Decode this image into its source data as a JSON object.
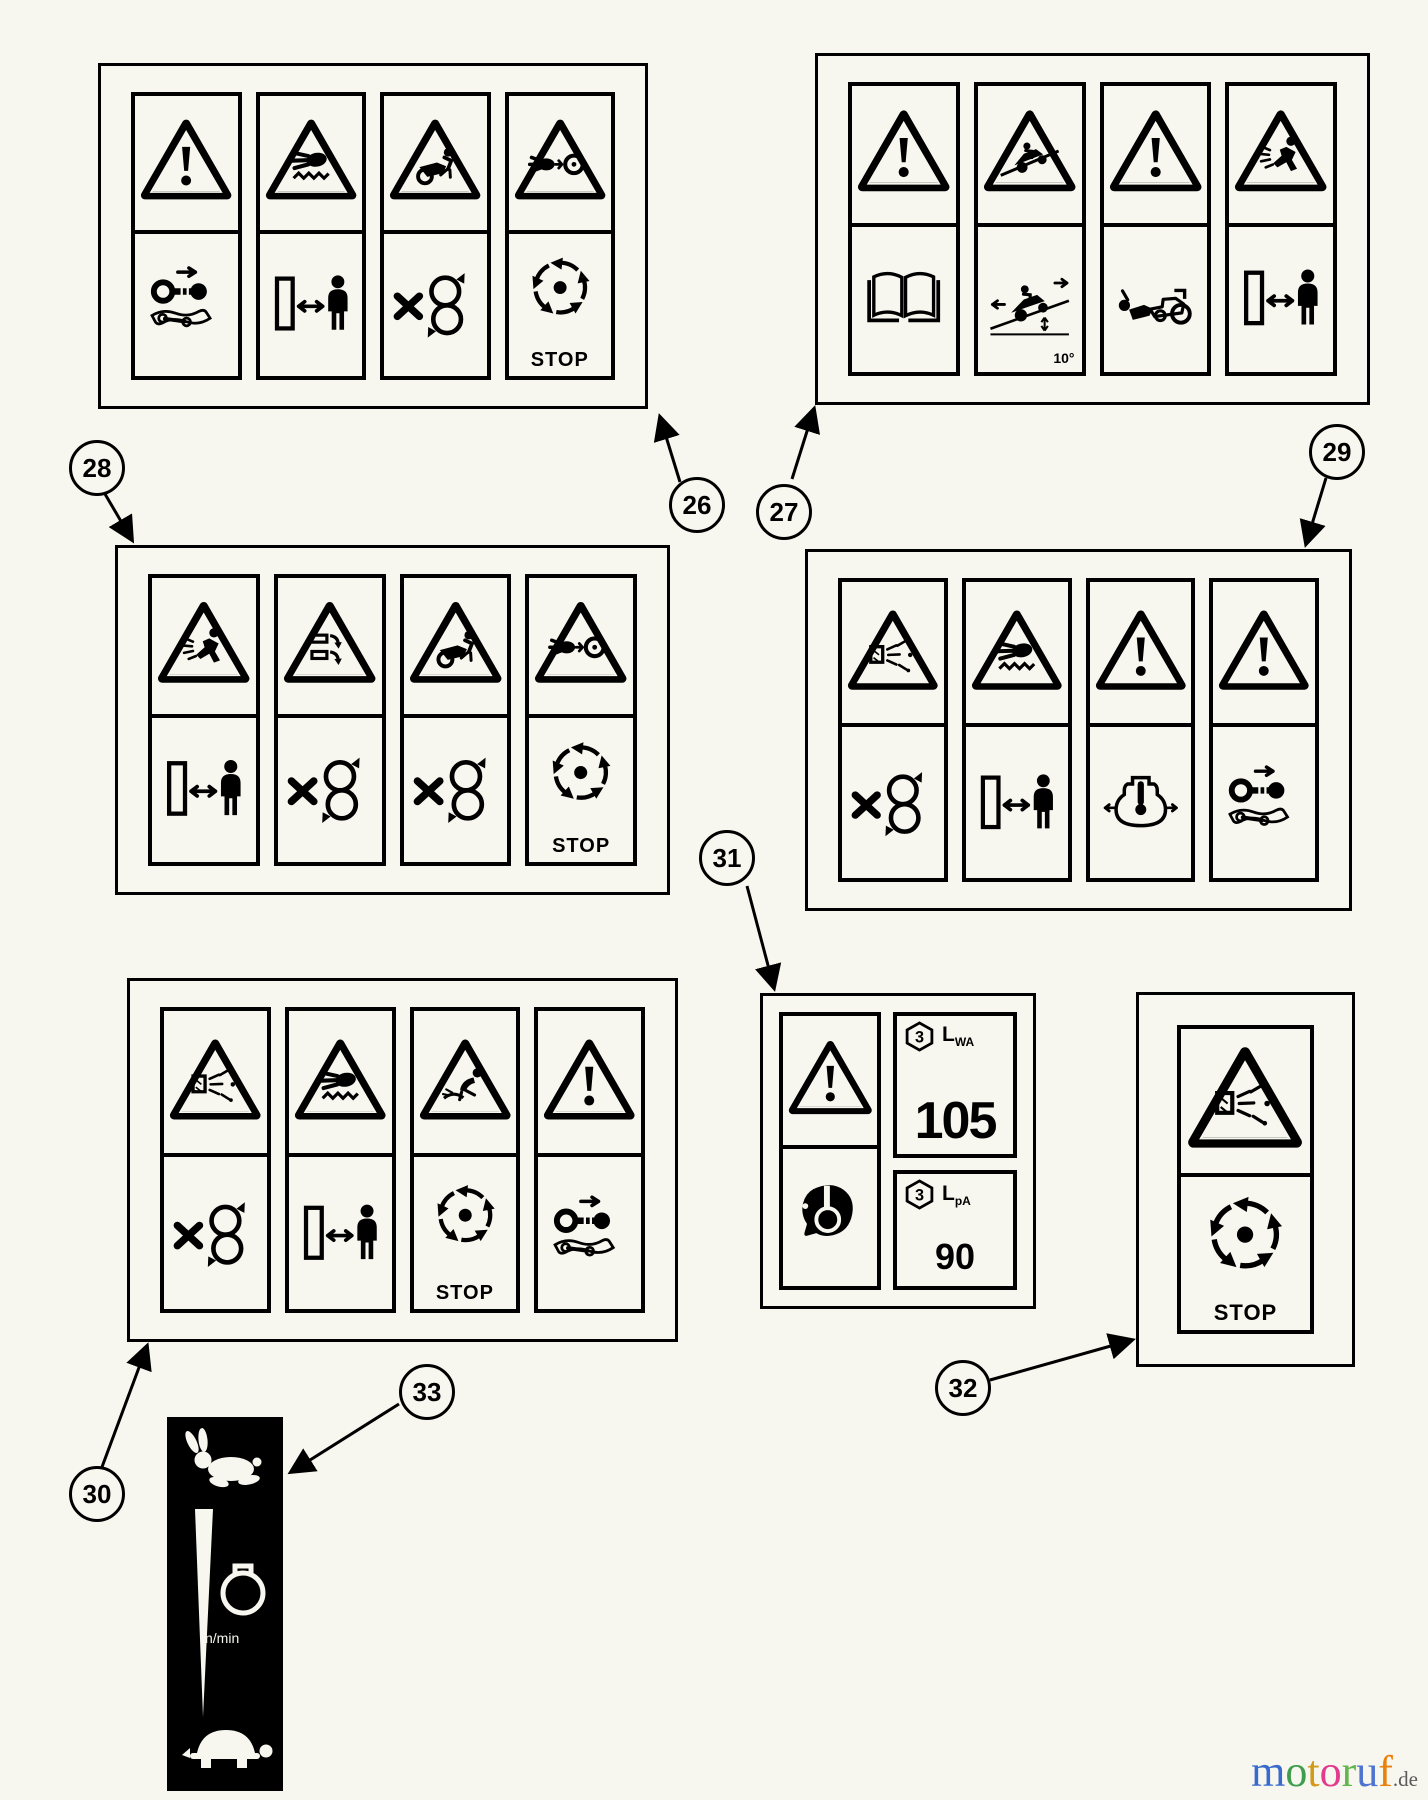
{
  "page": {
    "description": "Safety warning decal diagram sheet with numbered callouts",
    "background_color": "#f7f7ef"
  },
  "callouts": [
    {
      "number": "26"
    },
    {
      "number": "27"
    },
    {
      "number": "28"
    },
    {
      "number": "29"
    },
    {
      "number": "30"
    },
    {
      "number": "31"
    },
    {
      "number": "32"
    },
    {
      "number": "33"
    }
  ],
  "decal_panels": [
    {
      "name": "warning-decal-26",
      "callout": "26",
      "columns": [
        {
          "warning": "exclamation",
          "pictogram": "key-manual"
        },
        {
          "warning": "hand-cut",
          "pictogram": "keep-distance"
        },
        {
          "warning": "machine-tip",
          "pictogram": "no-blades"
        },
        {
          "warning": "hand-caught",
          "pictogram": "stop-dial",
          "label": "STOP"
        }
      ]
    },
    {
      "name": "warning-decal-27",
      "callout": "27",
      "columns": [
        {
          "warning": "exclamation",
          "pictogram": "read-manual"
        },
        {
          "warning": "slope-tip",
          "pictogram": "slope-limit",
          "label": "10°",
          "label_class": "corner"
        },
        {
          "warning": "exclamation",
          "pictogram": "reverse-runover"
        },
        {
          "warning": "thrown-objects",
          "pictogram": "keep-distance"
        }
      ]
    },
    {
      "name": "warning-decal-28",
      "callout": "28",
      "columns": [
        {
          "warning": "thrown-objects",
          "pictogram": "keep-distance"
        },
        {
          "warning": "cutter-bars",
          "pictogram": "no-blades"
        },
        {
          "warning": "machine-tip",
          "pictogram": "no-blades"
        },
        {
          "warning": "hand-caught",
          "pictogram": "stop-dial",
          "label": "STOP"
        }
      ]
    },
    {
      "name": "warning-decal-29",
      "callout": "29",
      "columns": [
        {
          "warning": "debris-eject",
          "pictogram": "no-blades"
        },
        {
          "warning": "hand-cut",
          "pictogram": "keep-distance"
        },
        {
          "warning": "exclamation",
          "pictogram": "radiator-pressure"
        },
        {
          "warning": "exclamation",
          "pictogram": "key-manual"
        }
      ]
    },
    {
      "name": "warning-decal-30",
      "callout": "30",
      "columns": [
        {
          "warning": "debris-eject",
          "pictogram": "no-blades"
        },
        {
          "warning": "hand-cut",
          "pictogram": "keep-distance"
        },
        {
          "warning": "child-nearby",
          "pictogram": "stop-dial",
          "label": "STOP"
        },
        {
          "warning": "exclamation",
          "pictogram": "key-manual"
        }
      ]
    },
    {
      "name": "warning-decal-32",
      "callout": "32",
      "columns": [
        {
          "warning": "debris-eject",
          "pictogram": "stop-dial",
          "label": "STOP"
        }
      ]
    }
  ],
  "noise_decal": {
    "name": "noise-level-decal-31",
    "callout": "31",
    "cert_number": "3",
    "lwa": {
      "symbol": "L",
      "sub": "WA",
      "value": "105"
    },
    "lpa": {
      "symbol": "L",
      "sub": "pA",
      "value": "90"
    }
  },
  "speed_decal": {
    "name": "throttle-speed-decal-33",
    "callout": "33",
    "rpm_label": "n/min",
    "fast_icon": "rabbit-icon",
    "slow_icon": "turtle-icon",
    "gauge_icon": "tachometer-icon"
  },
  "branding": {
    "letters": [
      {
        "ch": "m",
        "color": "#3a6bcc"
      },
      {
        "ch": "o",
        "color": "#3f9e4d"
      },
      {
        "ch": "t",
        "color": "#d29a18"
      },
      {
        "ch": "o",
        "color": "#e23a8e"
      },
      {
        "ch": "r",
        "color": "#63b54f"
      },
      {
        "ch": "u",
        "color": "#4f74d0"
      },
      {
        "ch": "f",
        "color": "#e8820c"
      }
    ],
    "suffix": ".de",
    "suffix_color": "#5a5a5a"
  }
}
